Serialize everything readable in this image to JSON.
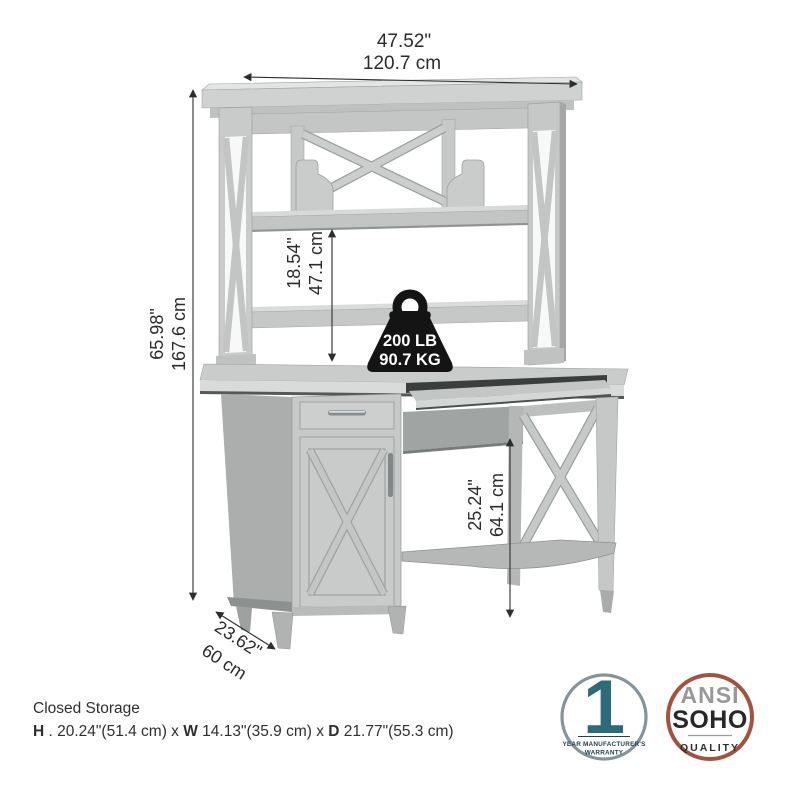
{
  "product": {
    "dimensions": {
      "overall_width": {
        "inches": "47.52\"",
        "cm": "120.7 cm"
      },
      "overall_height": {
        "inches": "65.98\"",
        "cm": "167.6 cm"
      },
      "hutch_clearance": {
        "inches": "18.54\"",
        "cm": "47.1 cm"
      },
      "knee_clearance": {
        "inches": "25.24\"",
        "cm": "64.1 cm"
      },
      "depth": {
        "inches": "23.62\"",
        "cm": "60 cm"
      }
    },
    "weight_capacity": {
      "pounds": "200 LB",
      "kilograms": "90.7 KG"
    },
    "closed_storage": {
      "title": "Closed Storage",
      "h_label": "H",
      "h_value": " . 20.24\"(51.4 cm) x ",
      "w_label": "W",
      "w_value": " 14.13\"(35.9 cm) x ",
      "d_label": "D",
      "d_value": " 21.77\"(55.3 cm)"
    }
  },
  "badges": {
    "warranty": {
      "number": "1",
      "line1": "YEAR MANUFACTURER'S",
      "line2": "WARRANTY"
    },
    "quality": {
      "line1": "ANSI",
      "line2": "SOHO",
      "line3": "QUALITY"
    }
  },
  "colors": {
    "furniture_light": "#c9cccb",
    "furniture_mid": "#b3b6b5",
    "furniture_dark": "#9fa3a2",
    "dimension_line": "#2e2e2e",
    "weight_badge": "#141414",
    "warranty_ring": "#85939d",
    "warranty_accent": "#2e6b7a",
    "warranty_text": "#23404e",
    "quality_ring": "#a3523f",
    "quality_gray": "#98989a",
    "quality_dark": "#282828"
  }
}
